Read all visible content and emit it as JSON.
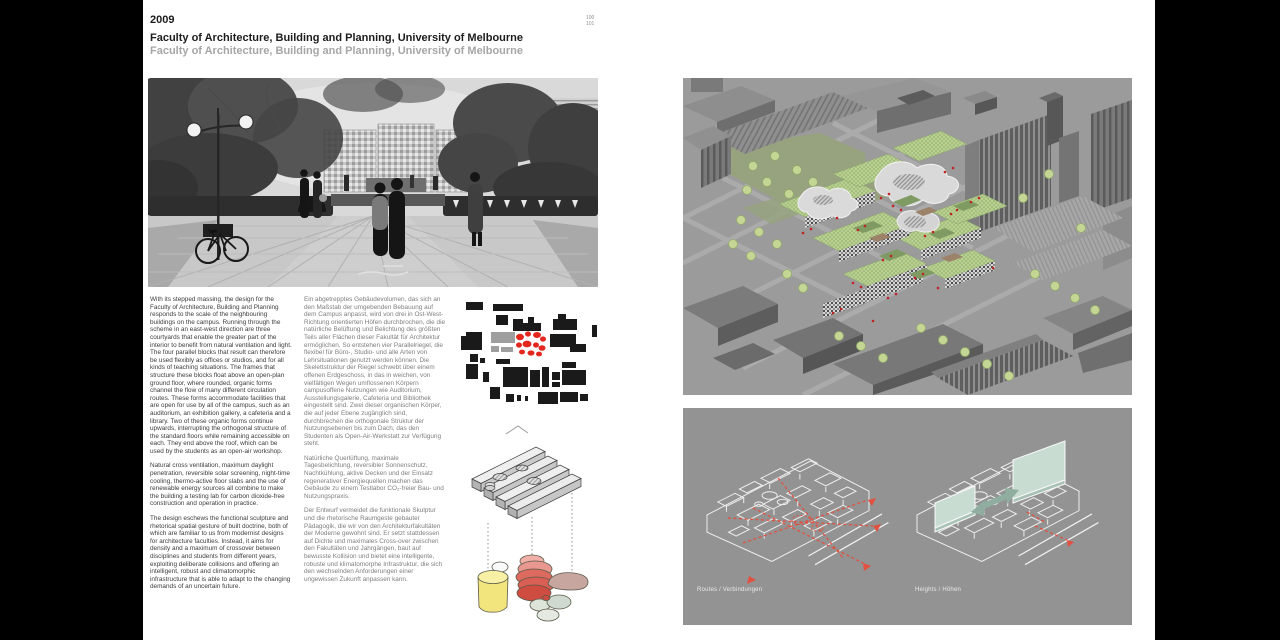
{
  "header": {
    "year": "2009",
    "title": "Faculty of Architecture, Building and Planning, University of Melbourne",
    "subtitle": "Faculty of Architecture, Building and Planning, University of Melbourne"
  },
  "page_numbers": {
    "top": "100",
    "bottom": "101"
  },
  "columns": {
    "english": {
      "paragraphs": [
        "With its stepped massing, the design for the Faculty of Architecture, Building and Planning responds to the scale of the neighbouring buildings on the campus. Running through the scheme in an east-west direction are three courtyards that enable the greater part of the interior to benefit from natural ventilation and light. The four parallel blocks that result can therefore be used flexibly as offices or studios, and for all kinds of teaching situations. The frames that structure these blocks float above an open-plan ground floor, where rounded, organic forms channel the flow of many different circulation routes. These forms accommodate facilities that are open for use by all of the campus, such as an auditorium, an exhibition gallery, a cafeteria and a library. Two of these organic forms continue upwards, interrupting the orthogonal structure of the standard floors while remaining accessible on each. They end above the roof, which can be used by the students as an open-air workshop.",
        "Natural cross ventilation, maximum daylight penetration, reversible solar screening, night-time cooling, thermo-active floor slabs and the use of renewable energy sources all combine to make the building a testing lab for carbon dioxide-free construction and operation in practice.",
        "The design eschews the functional sculpture and rhetorical spatial gesture of built doctrine, both of which are familiar to us from modernist designs for architecture faculties. Instead, it aims for density and a maximum of crossover between disciplines and students from different years, exploiting deliberate collisions and offering an intelligent, robust and climatomorphic infrastructure that is able to adapt to the changing demands of an uncertain future."
      ]
    },
    "german": {
      "paragraphs": [
        "Ein abgetrepptes Gebäudevolumen, das sich an den Maßstab der umgebenden Bebauung auf dem Campus anpasst, wird von drei in Ost-West-Richtung orientierten Höfen durchbrochen, die die natürliche Belüftung und Belichtung des größten Teils aller Flächen dieser Fakultät für Architektur ermöglichen. So entstehen vier Parallelriegel, die flexibel für Büro-, Studio- und alle Arten von Lehrsituationen genutzt werden können. Die Skelettstruktur der Riegel schwebt über einem offenen Erdgeschoss, in das in weichen, von vielfältigen Wegen umflossenen Körpern campusoffene Nutzungen wie Auditorium, Ausstellungsgalerie, Cafeteria und Bibliothek eingestellt sind. Zwei dieser organischen Körper, die auf jeder Ebene zugänglich sind, durchbrechen die orthogonale Struktur der Nutzungsebenen bis zum Dach, das den Studenten als Open-Air-Werkstatt zur Verfügung steht.",
        "Natürliche Querlüftung, maximale Tagesbelichtung, reversibler Sonnenschutz, Nachtkühlung, aktive Decken und der Einsatz regenerativer Energiequellen machen das Gebäude zu einem Testlabor CO₂-freier Bau- und Nutzungspraxis.",
        "Der Entwurf vermeidet die funktionale Skulptur und die rhetorische Raumgeste gebauter Pädagogik, die wir von den Architekturfakultäten der Moderne gewohnt sind. Er setzt stattdessen auf Dichte und maximales Cross-over zwischen den Fakultäten und Jahrgängen, baut auf bewusste Kollision und bietet eine intelligente, robuste und klimatomorphe Infrastruktur, die sich den wechselnden Anforderungen einer ungewissen Zukunft anpassen kann."
      ]
    }
  },
  "captions": {
    "routes": "Routes / Verbindungen",
    "heights": "Heights / Höhen"
  },
  "colors": {
    "accent_red": "#e3271e",
    "render_red": "#bf2323",
    "route_red": "#e2503f",
    "tree_green": "#c4d594",
    "lawn_green": "#97a27f",
    "blob_yellow": "#f3e57e",
    "blob_red": "#d95f54",
    "blob_mauve": "#c7a6a0",
    "teal_plane": "#c9dcd2",
    "sage_arrow": "#8fae9f",
    "render_bg": "#9b9b9b",
    "diagram_bg": "#939393"
  }
}
